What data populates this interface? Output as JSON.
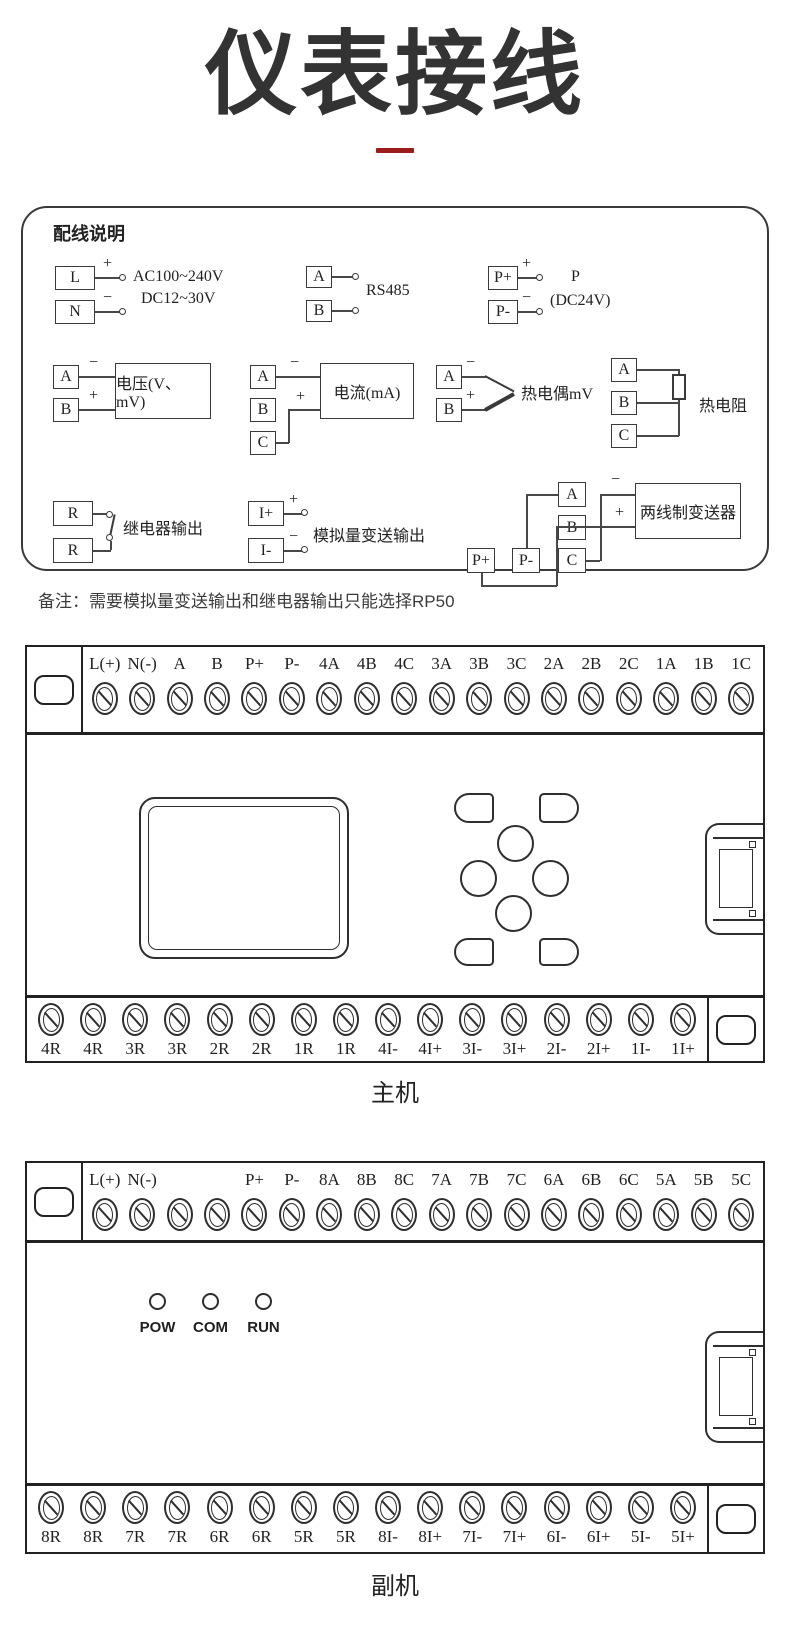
{
  "title": "仪表接线",
  "accent_color": "#9c1b1b",
  "note": "备注：需要模拟量变送输出和继电器输出只能选择RP50",
  "wiring": {
    "heading": "配线说明",
    "plus": "+",
    "minus": "−",
    "power": {
      "t1": "L",
      "t2": "N",
      "label1": "AC100~240V",
      "label2": "DC12~30V"
    },
    "rs485": {
      "t1": "A",
      "t2": "B",
      "label": "RS485"
    },
    "power_out": {
      "t1": "P+",
      "t2": "P-",
      "label1": "P",
      "label2": "(DC24V)"
    },
    "voltage": {
      "t1": "A",
      "t2": "B",
      "label": "电压(V、mV)"
    },
    "current": {
      "t1": "A",
      "t2": "B",
      "t3": "C",
      "label": "电流(mA)"
    },
    "thermocouple": {
      "t1": "A",
      "t2": "B",
      "label": "热电偶mV"
    },
    "rtd": {
      "t1": "A",
      "t2": "B",
      "t3": "C",
      "label": "热电阻"
    },
    "relay": {
      "t1": "R",
      "t2": "R",
      "label": "继电器输出"
    },
    "analog": {
      "t1": "I+",
      "t2": "I-",
      "label": "模拟量变送输出"
    },
    "transmitter": {
      "t1": "A",
      "t2": "B",
      "t3": "C",
      "p1": "P+",
      "p2": "P-",
      "label": "两线制变送器"
    }
  },
  "main_unit": {
    "caption": "主机",
    "top_terminals": [
      "L(+)",
      "N(-)",
      "A",
      "B",
      "P+",
      "P-",
      "4A",
      "4B",
      "4C",
      "3A",
      "3B",
      "3C",
      "2A",
      "2B",
      "2C",
      "1A",
      "1B",
      "1C"
    ],
    "bottom_terminals": [
      "4R",
      "4R",
      "3R",
      "3R",
      "2R",
      "2R",
      "1R",
      "1R",
      "4I-",
      "4I+",
      "3I-",
      "3I+",
      "2I-",
      "2I+",
      "1I-",
      "1I+"
    ]
  },
  "sub_unit": {
    "caption": "副机",
    "top_terminals": [
      "L(+)",
      "N(-)",
      "",
      "",
      "P+",
      "P-",
      "8A",
      "8B",
      "8C",
      "7A",
      "7B",
      "7C",
      "6A",
      "6B",
      "6C",
      "5A",
      "5B",
      "5C"
    ],
    "bottom_terminals": [
      "8R",
      "8R",
      "7R",
      "7R",
      "6R",
      "6R",
      "5R",
      "5R",
      "8I-",
      "8I+",
      "7I-",
      "7I+",
      "6I-",
      "6I+",
      "5I-",
      "5I+"
    ],
    "leds": [
      "POW",
      "COM",
      "RUN"
    ]
  }
}
